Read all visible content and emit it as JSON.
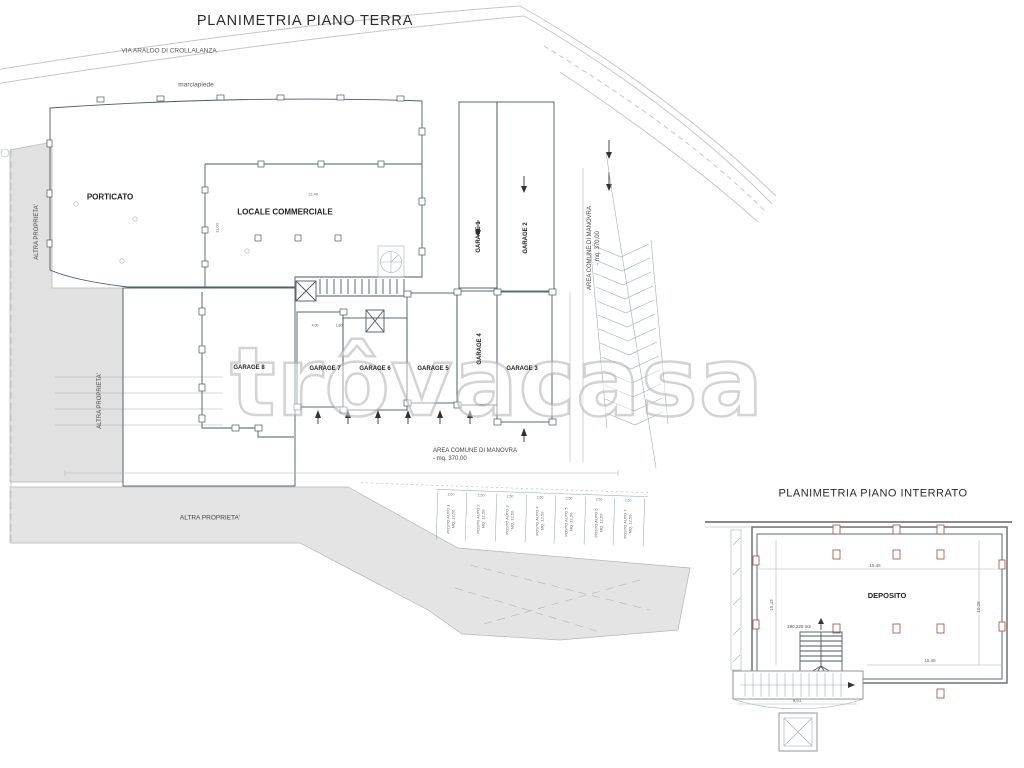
{
  "watermark": {
    "text": "trôvacasa"
  },
  "colors": {
    "cyan": "#7EEFEF",
    "property_gray": "#E1E1E1",
    "road_gray": "#E4E4E4"
  },
  "ground_floor": {
    "title": "PLANIMETRIA PIANO TERRA",
    "street_label": "VIA ARALDO DI CROLLALANZA",
    "sidewalk_label": "marciapiede",
    "rooms": [
      {
        "label": "PORTICATO",
        "color": "#7EEFEF"
      },
      {
        "label": "LOCALE COMMERCIALE",
        "color": "#7EEFEF"
      }
    ],
    "garages": [
      {
        "label": "GARAGE 1",
        "color": "#FDF000"
      },
      {
        "label": "GARAGE 2",
        "color": "#EF7E7E"
      },
      {
        "label": "GARAGE 3",
        "color": "#57C8F2"
      },
      {
        "label": "GARAGE 4",
        "color": "#A3E145"
      },
      {
        "label": "GARAGE 5",
        "color": "#CA5EDB"
      },
      {
        "label": "GARAGE 6",
        "color": "#BDBDBD"
      },
      {
        "label": "GARAGE 7",
        "color": "#5F84DC"
      },
      {
        "label": "GARAGE 8",
        "color": "#CCE6B8"
      }
    ],
    "other_property_label": "ALTRA PROPRIETA'",
    "maneuver_area_label": "AREA COMUNE DI MANOVRA\n- mq. 370,00",
    "parking_spots": [
      "POSTO AUTO 1\nMQ. 12,50",
      "POSTO AUTO 2\nMQ. 12,50",
      "POSTO AUTO 3\nMQ. 12,50",
      "POSTO AUTO 4\nMQ. 12,50",
      "POSTO AUTO 5\nMQ. 12,50",
      "POSTO AUTO 6\nMQ. 12,50",
      "POSTO AUTO 7\nMQ. 12,50"
    ],
    "dims": {
      "stall_width": "2,50",
      "commercial_width": "12,40",
      "porticato_height": "11,00",
      "garage7_a": "4,00",
      "garage7_b": "1,80"
    }
  },
  "basement": {
    "title": "PLANIMETRIA PIANO INTERRATO",
    "room_label": "DEPOSITO",
    "room_color": "#7EEFEF",
    "area_text": "190,220 m2",
    "dims": {
      "top": "15,45",
      "left": "15,43",
      "bottom": "15,48",
      "right": "10,28",
      "entry_width": "9,61"
    }
  }
}
